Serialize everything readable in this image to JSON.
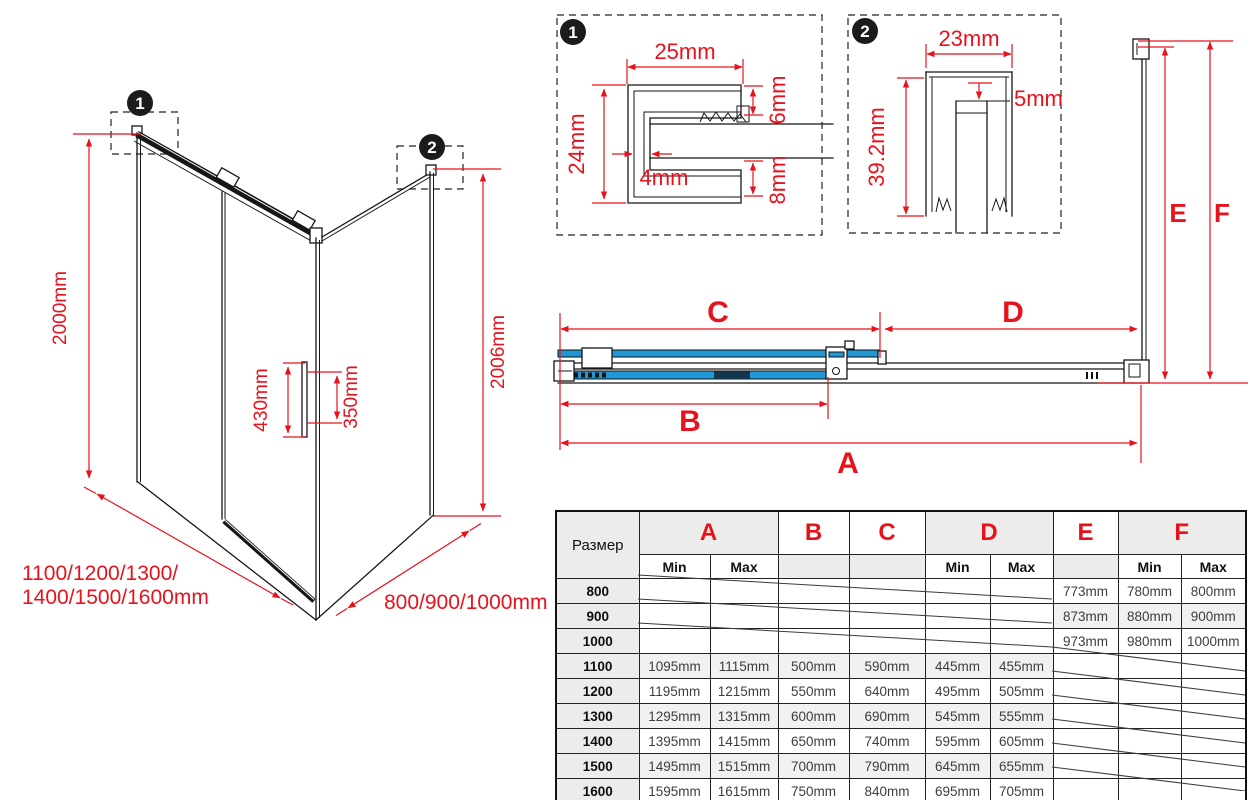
{
  "colors": {
    "dimension_red": "#e8121c",
    "glass_blue": "#2098d6",
    "line_black": "#161616",
    "header_shade": "#ececea",
    "row_shade": "#f1f1ef"
  },
  "iso": {
    "marker1": "1",
    "marker2": "2",
    "height_left": "2000mm",
    "height_right": "2006mm",
    "handle_outer": "430mm",
    "handle_inner": "350mm",
    "width_label_line1": "1100/1200/1300/",
    "width_label_line2": "1400/1500/1600mm",
    "depth_label": "800/900/1000mm"
  },
  "detail1": {
    "badge": "1",
    "dim_top": "25mm",
    "dim_left": "24mm",
    "dim_slot": "4mm",
    "dim_right_top": "6mm",
    "dim_right_bottom": "8mm"
  },
  "detail2": {
    "badge": "2",
    "dim_top": "23mm",
    "dim_inset": "5mm",
    "dim_left": "39.2mm"
  },
  "plan": {
    "dim_a": "A",
    "dim_b": "B",
    "dim_c": "C",
    "dim_d": "D",
    "dim_e": "E",
    "dim_f": "F"
  },
  "table": {
    "corner_label": "Размер",
    "min_label": "Min",
    "max_label": "Max",
    "columns": {
      "a": "A",
      "b": "B",
      "c": "C",
      "d": "D",
      "e": "E",
      "f": "F"
    },
    "rows": [
      {
        "size": "800",
        "a_min": "",
        "a_max": "",
        "b": "",
        "c": "",
        "d_min": "",
        "d_max": "",
        "e": "773mm",
        "f_min": "780mm",
        "f_max": "800mm",
        "crossed": "abcd"
      },
      {
        "size": "900",
        "a_min": "",
        "a_max": "",
        "b": "",
        "c": "",
        "d_min": "",
        "d_max": "",
        "e": "873mm",
        "f_min": "880mm",
        "f_max": "900mm",
        "crossed": "abcd"
      },
      {
        "size": "1000",
        "a_min": "",
        "a_max": "",
        "b": "",
        "c": "",
        "d_min": "",
        "d_max": "",
        "e": "973mm",
        "f_min": "980mm",
        "f_max": "1000mm",
        "crossed": "abcd"
      },
      {
        "size": "1100",
        "a_min": "1095mm",
        "a_max": "1115mm",
        "b": "500mm",
        "c": "590mm",
        "d_min": "445mm",
        "d_max": "455mm",
        "e": "",
        "f_min": "",
        "f_max": "",
        "crossed": "ef"
      },
      {
        "size": "1200",
        "a_min": "1195mm",
        "a_max": "1215mm",
        "b": "550mm",
        "c": "640mm",
        "d_min": "495mm",
        "d_max": "505mm",
        "e": "",
        "f_min": "",
        "f_max": "",
        "crossed": "ef"
      },
      {
        "size": "1300",
        "a_min": "1295mm",
        "a_max": "1315mm",
        "b": "600mm",
        "c": "690mm",
        "d_min": "545mm",
        "d_max": "555mm",
        "e": "",
        "f_min": "",
        "f_max": "",
        "crossed": "ef"
      },
      {
        "size": "1400",
        "a_min": "1395mm",
        "a_max": "1415mm",
        "b": "650mm",
        "c": "740mm",
        "d_min": "595mm",
        "d_max": "605mm",
        "e": "",
        "f_min": "",
        "f_max": "",
        "crossed": "ef"
      },
      {
        "size": "1500",
        "a_min": "1495mm",
        "a_max": "1515mm",
        "b": "700mm",
        "c": "790mm",
        "d_min": "645mm",
        "d_max": "655mm",
        "e": "",
        "f_min": "",
        "f_max": "",
        "crossed": "ef"
      },
      {
        "size": "1600",
        "a_min": "1595mm",
        "a_max": "1615mm",
        "b": "750mm",
        "c": "840mm",
        "d_min": "695mm",
        "d_max": "705mm",
        "e": "",
        "f_min": "",
        "f_max": "",
        "crossed": "ef"
      }
    ]
  }
}
